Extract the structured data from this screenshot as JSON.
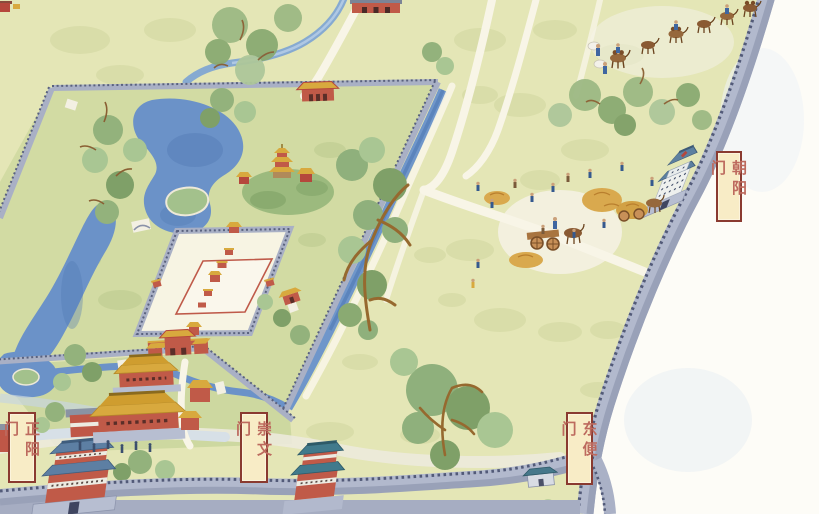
{
  "map": {
    "type": "illustrated-watercolor-city-map",
    "language": "zh",
    "gate_labels": {
      "chaoyangmen": "朝阳门",
      "zhengyangmen": "正阳门",
      "chongwenmen": "崇文门",
      "dongbianmen": "东便门"
    },
    "label_style": {
      "background": "#f8ecc6",
      "border": "#8a3a30",
      "text_color": "#bd6a5e"
    },
    "palette": {
      "field": "#e4e6b6",
      "garden_green": "#d2dba3",
      "water_blue": "#6b92c8",
      "wall_gray": "#b2b9cd",
      "roof_blue": "#5d80a0",
      "roof_teal": "#417a8c",
      "roof_gold": "#d8a93e",
      "building_red": "#c05a48",
      "path_white": "#f8f5e7"
    }
  }
}
